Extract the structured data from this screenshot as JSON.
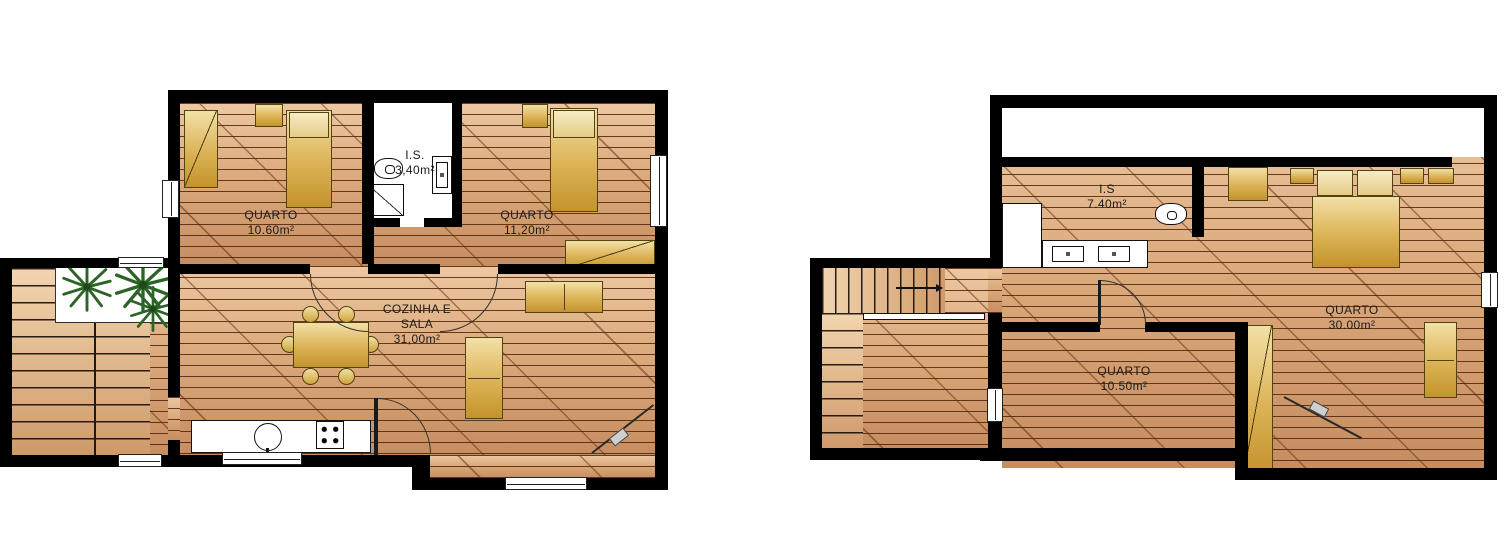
{
  "colors": {
    "wall": "#000000",
    "floor_light": "#ecc8a2",
    "floor_dark": "#c68d60",
    "plank_line": "#50220a",
    "furniture_light": "#f2e0a6",
    "furniture_dark": "#c3942c",
    "plant_green": "#2c6426",
    "label_text": "#1b1b1b",
    "background": "#ffffff"
  },
  "icons": {
    "plant": "palm-plant-icon",
    "stairs_direction": "arrow-right-icon",
    "kitchen_sink": "round-sink-icon",
    "stove": "four-burner-stove-icon",
    "toilet": "wc-icon",
    "shower": "shower-tray-icon",
    "guitar": "guitar-icon"
  },
  "plans": {
    "ground": {
      "rooms": {
        "quarto1": {
          "label": "QUARTO",
          "area": "10.60m²"
        },
        "is": {
          "label": "I.S.",
          "area": "3,40m²"
        },
        "quarto2": {
          "label": "QUARTO",
          "area": "11,20m²"
        },
        "living": {
          "line1": "COZINHA E",
          "line2": "SALA",
          "area": "31,00m²"
        }
      }
    },
    "upper": {
      "rooms": {
        "is": {
          "label": "I.S",
          "area": "7.40m²"
        },
        "quarto_main": {
          "label": "QUARTO",
          "area": "30.00m²"
        },
        "quarto_small": {
          "label": "QUARTO",
          "area": "10.50m²"
        }
      }
    }
  }
}
